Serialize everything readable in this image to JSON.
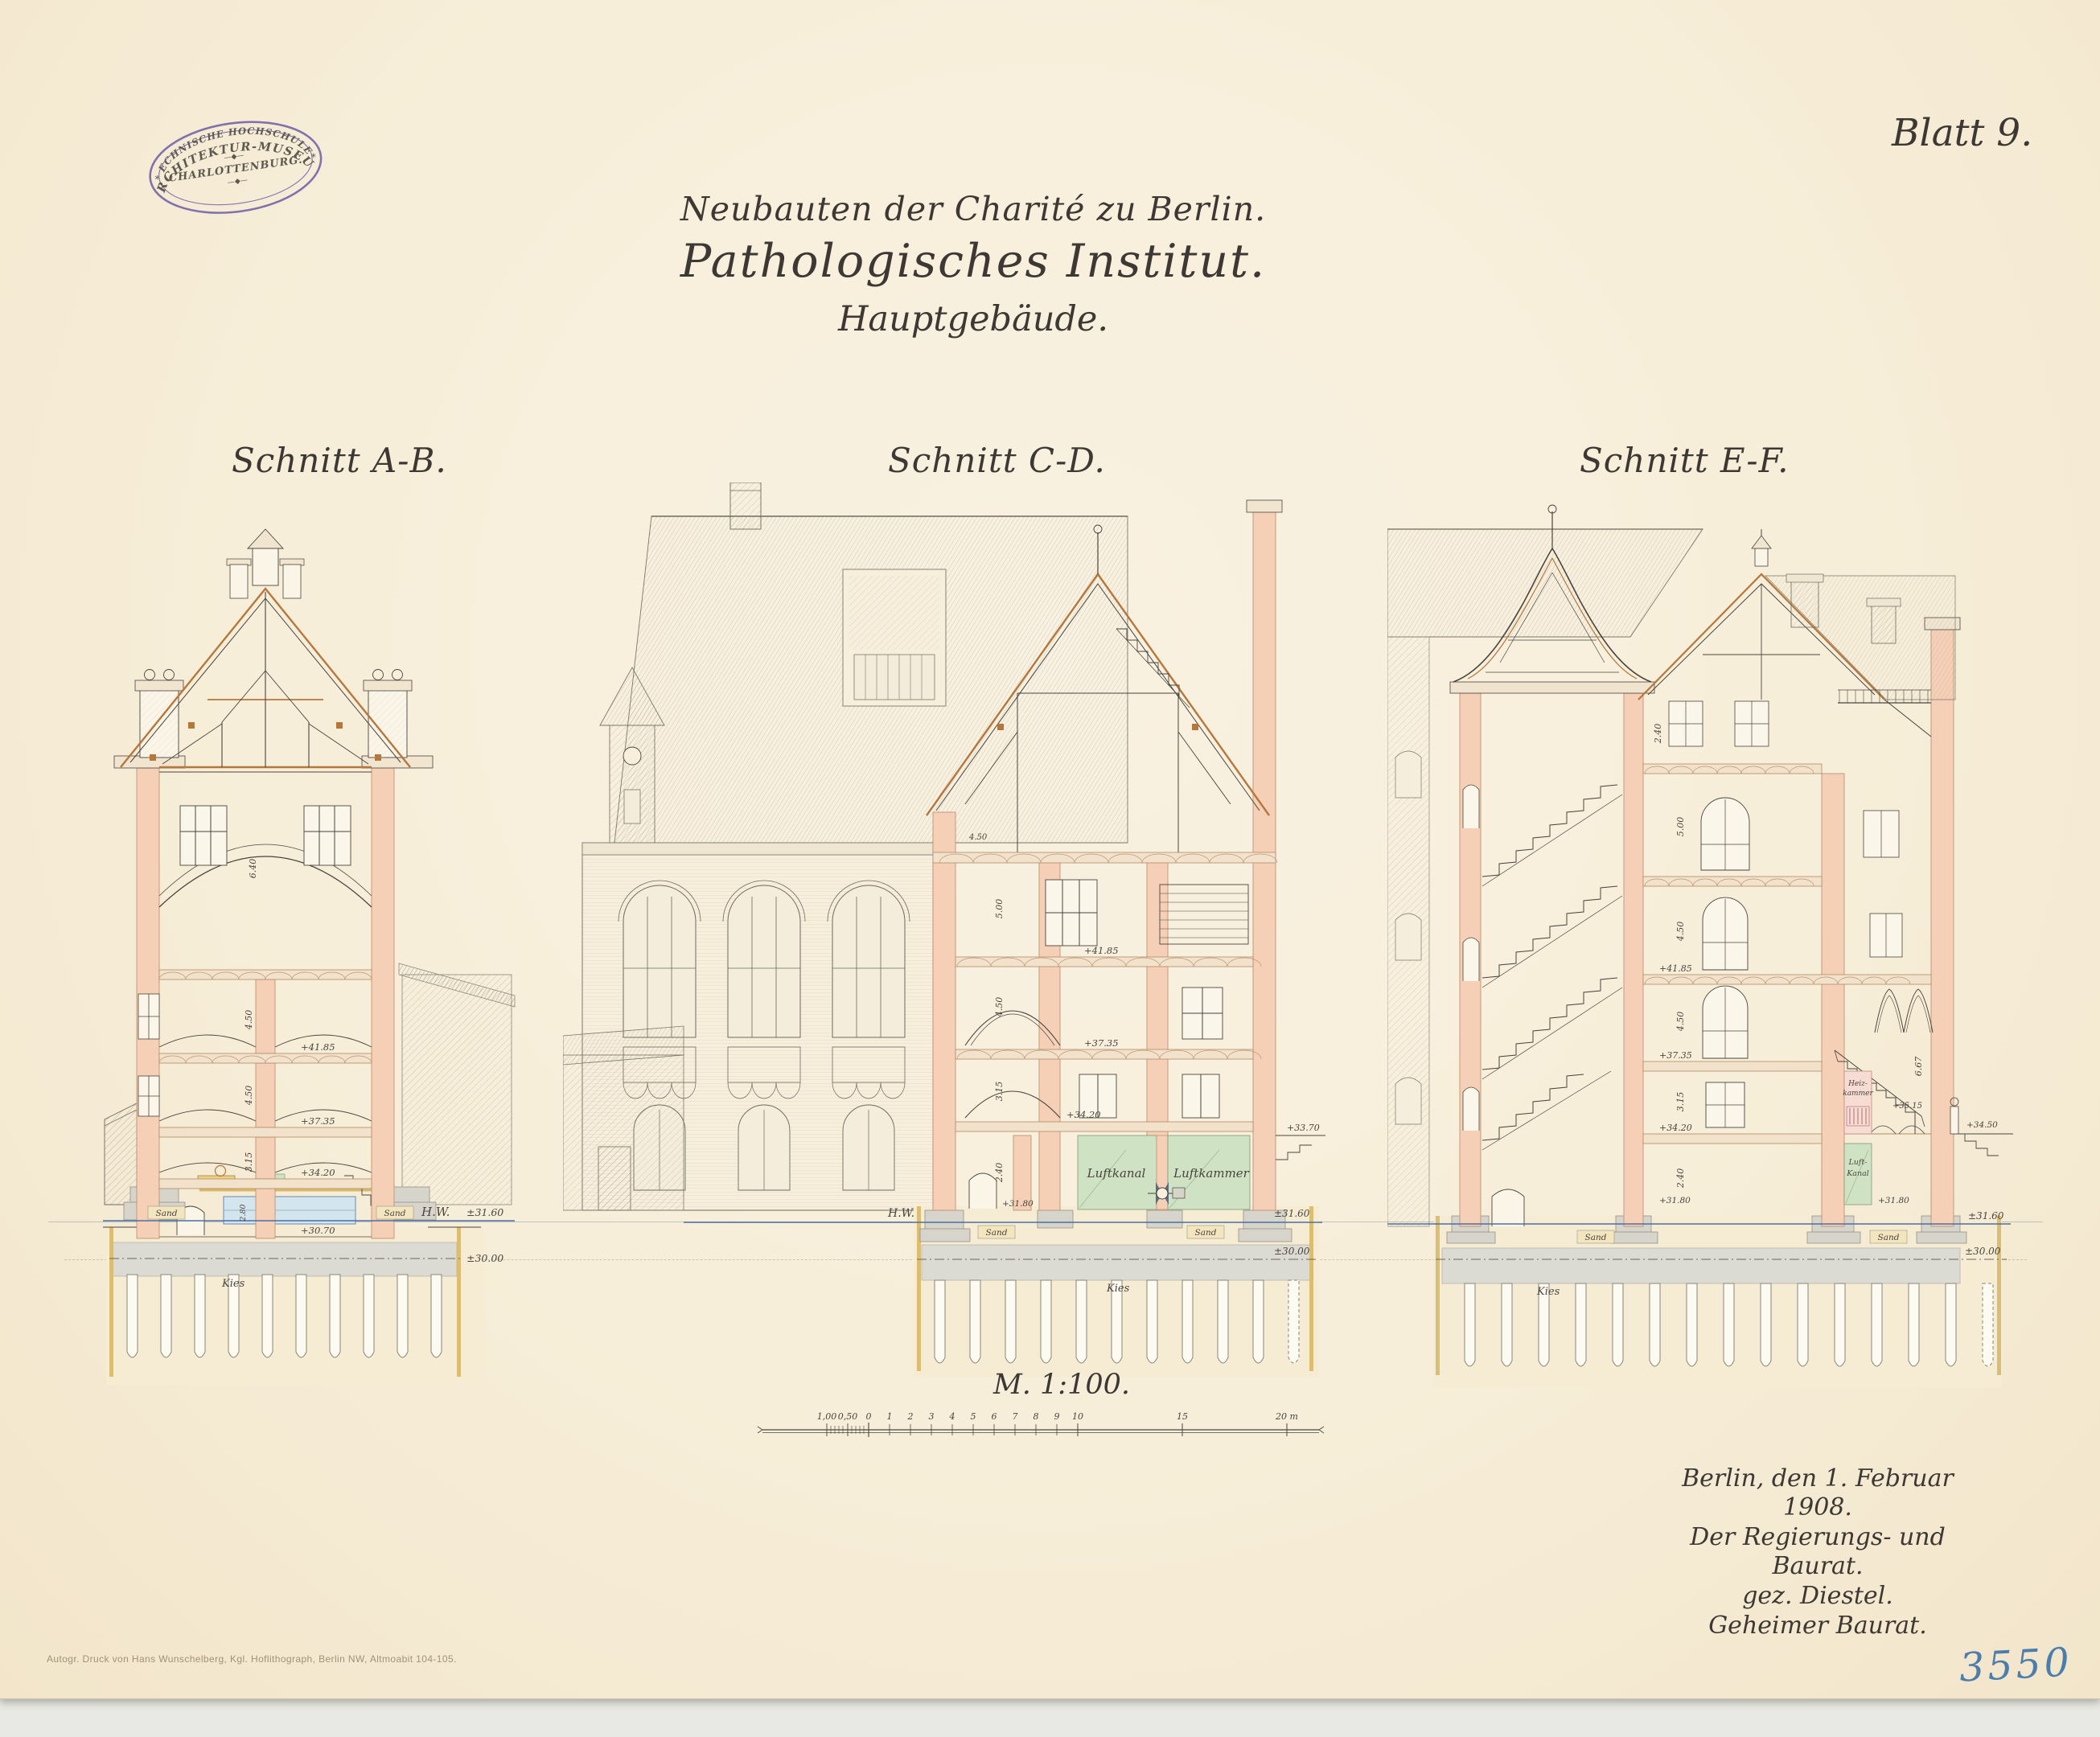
{
  "sheet": {
    "number_label": "Blatt 9.",
    "inventory_number": "3550",
    "imprint": "Autogr. Druck von Hans Wunschelberg, Kgl. Hoflithograph, Berlin NW, Altmoabit 104-105."
  },
  "stamp": {
    "top": "ARCHITEKTUR-MUSEUM",
    "middle": "CHARLOTTENBURG.",
    "bottom": "TECHNISCHE HOCHSCHULE.",
    "ornament_top": "—◆—",
    "ornament_bottom": "—◆—",
    "star_left": "*",
    "star_right": "*"
  },
  "title": {
    "line1": "Neubauten der Charité zu Berlin.",
    "line2": "Pathologisches Institut.",
    "line3": "Hauptgebäude."
  },
  "scale": {
    "label": "M. 1:100.",
    "ticks": [
      "1,00",
      "0,50",
      "0",
      "1",
      "2",
      "3",
      "4",
      "5",
      "6",
      "7",
      "8",
      "9",
      "10",
      "15",
      "20 m"
    ]
  },
  "signature": {
    "line1": "Berlin, den 1. Februar 1908.",
    "line2": "Der Regierungs- und Baurat.",
    "line3": "gez. Diestel.",
    "line4": "Geheimer Baurat."
  },
  "section_ab": {
    "label": "Schnitt A-B.",
    "levels": {
      "l4185": "+41.85",
      "l3735": "+37.35",
      "l3420": "+34.20",
      "l3070": "+30.70",
      "hw": "H.W.",
      "hw_value": "±31.60",
      "l3000": "±30.00"
    },
    "materials": {
      "sand_left": "Sand",
      "sand_right": "Sand",
      "kies": "Kies"
    },
    "dims": {
      "hall": "6.40",
      "d2": "4.50",
      "d3": "4.50",
      "d4": "3.15",
      "d5": "2.80"
    }
  },
  "section_cd": {
    "label": "Schnitt C-D.",
    "levels": {
      "l4185": "+41.85",
      "l3735": "+37.35",
      "l3420": "+34.20",
      "l3370": "+33.70",
      "l3180": "+31.80",
      "hw": "H.W.",
      "hw_value": "±31.60",
      "l3000": "±30.00"
    },
    "rooms": {
      "luftkanal": "Luftkanal",
      "luftkammer": "Luftkammer"
    },
    "materials": {
      "sand_left": "Sand",
      "sand_right": "Sand",
      "kies": "Kies"
    },
    "dims": {
      "attic": "4.50",
      "d1": "5.00",
      "d2": "4.50",
      "d3": "3.15",
      "d4": "2.40"
    }
  },
  "section_ef": {
    "label": "Schnitt E-F.",
    "levels": {
      "l4185": "+41.85",
      "l3735": "+37.35",
      "l3420": "+34.20",
      "l3515": "+35.15",
      "l3450": "+34.50",
      "l3180a": "+31.80",
      "l3180b": "+31.80",
      "hw_value": "±31.60",
      "l3000": "±30.00"
    },
    "rooms": {
      "heiz_line1": "Heiz-",
      "heiz_line2": "kammer",
      "luft_line1": "Luft-",
      "luft_line2": "Kanal"
    },
    "materials": {
      "sand_left": "Sand",
      "sand_right": "Sand",
      "kies": "Kies"
    },
    "dims": {
      "attic": "2.40",
      "d1": "5.00",
      "d2": "4.50",
      "d3": "4.50",
      "d4": "3.15",
      "d5": "2.40",
      "hall": "6.67"
    }
  }
}
